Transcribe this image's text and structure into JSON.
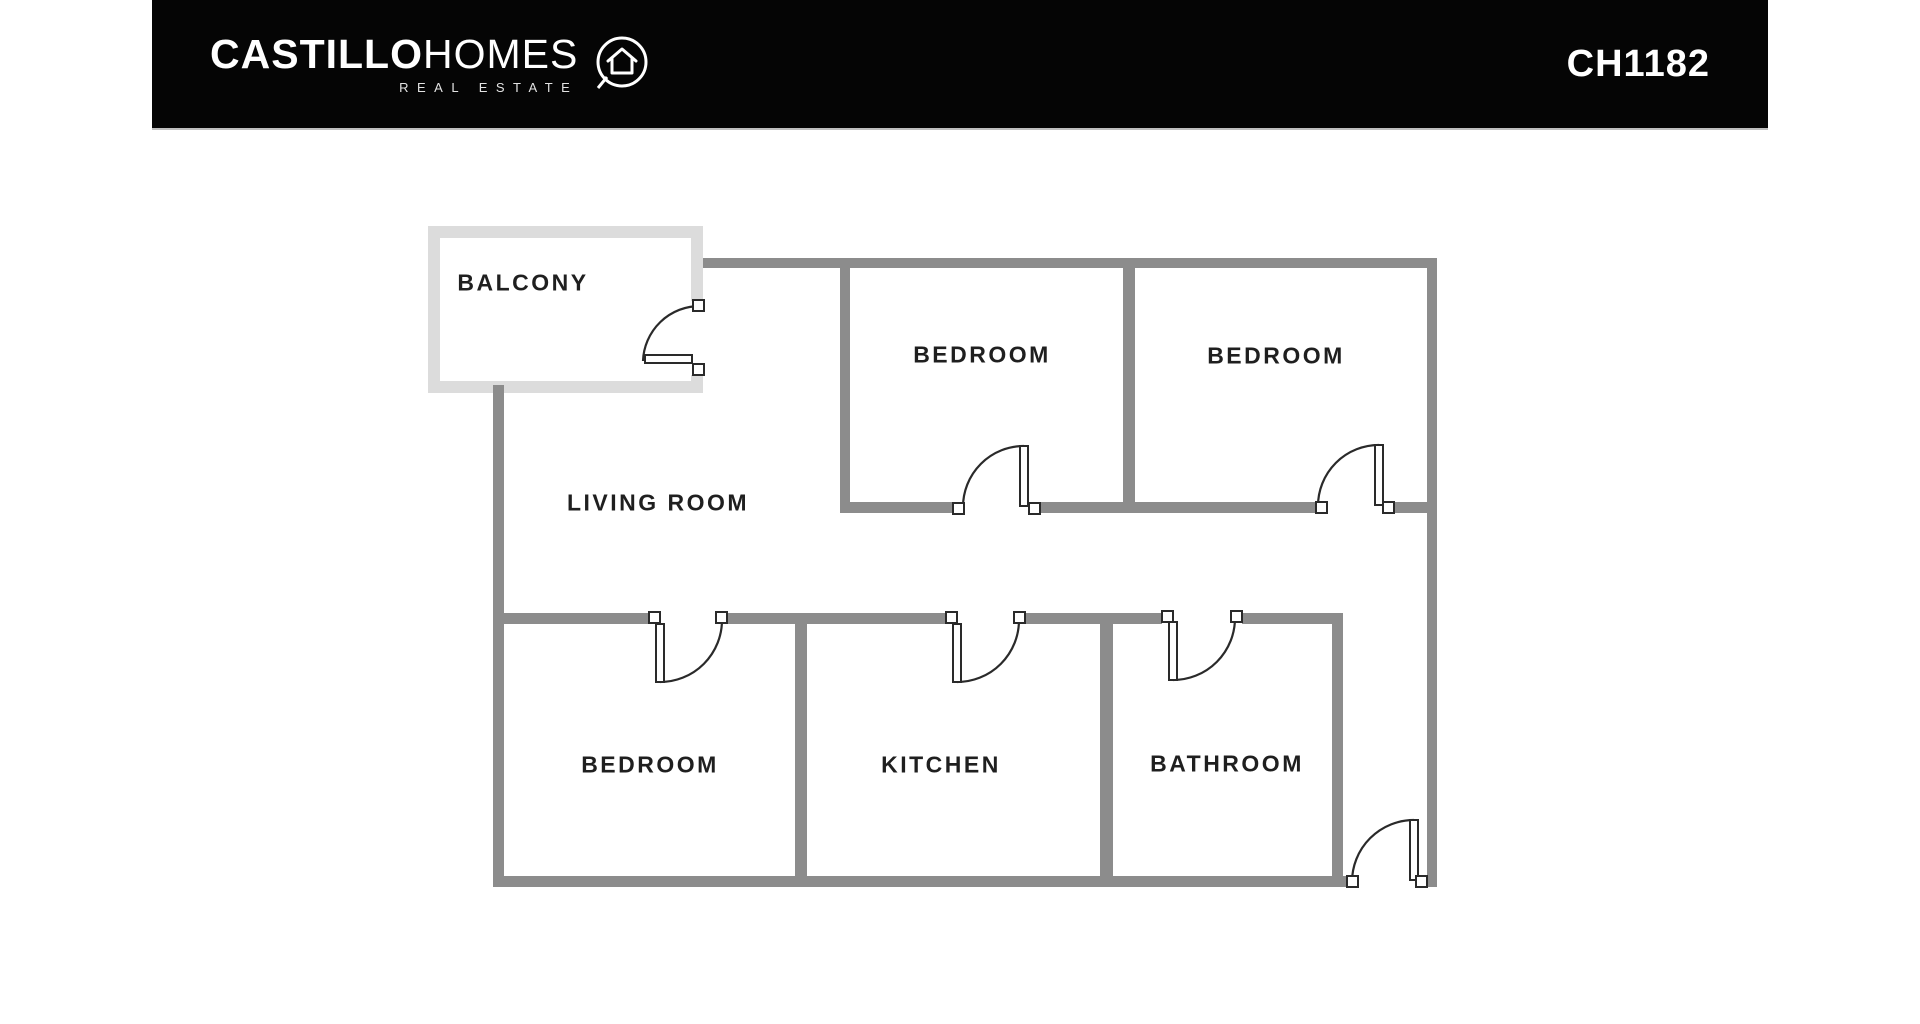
{
  "header": {
    "brand": {
      "bold": "CASTILLO",
      "light": "HOMES",
      "tagline": "REAL ESTATE",
      "logo_icon": "house-in-circle-icon"
    },
    "listing_id": "CH1182",
    "bar_color": "#050505",
    "text_color": "#ffffff"
  },
  "floor_plan": {
    "wall_color": "#8c8c8c",
    "balcony_wall_color": "#dcdcdc",
    "label_color": "#1f1f1f",
    "door_line_color": "#2a2a2a",
    "rooms": [
      {
        "id": "balcony",
        "label": "BALCONY"
      },
      {
        "id": "living-room",
        "label": "LIVING ROOM"
      },
      {
        "id": "bedroom-1",
        "label": "BEDROOM"
      },
      {
        "id": "bedroom-2",
        "label": "BEDROOM"
      },
      {
        "id": "bedroom-3",
        "label": "BEDROOM"
      },
      {
        "id": "kitchen",
        "label": "KITCHEN"
      },
      {
        "id": "bathroom",
        "label": "BATHROOM"
      }
    ],
    "door_count": 7
  }
}
